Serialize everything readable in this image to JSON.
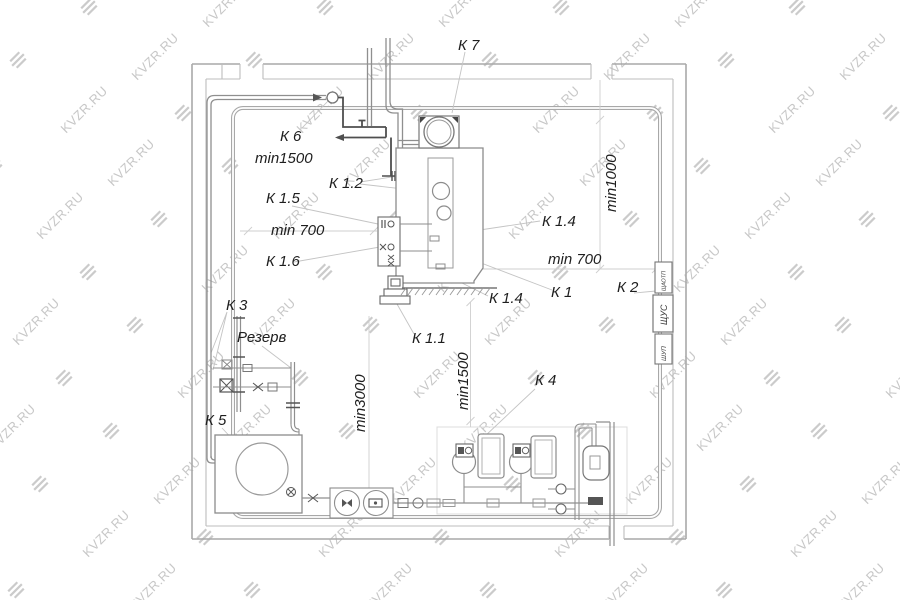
{
  "title": "Boiler room layout plan (план котельной)",
  "watermark": {
    "text": "KVZR.RU"
  },
  "labels": {
    "k7": "К 7",
    "k6": "К 6",
    "min1500_top": "min1500",
    "k12": "К 1.2",
    "k15": "К 1.5",
    "min700_left": "min 700",
    "k16": "К 1.6",
    "min1000": "min1000",
    "k14_top": "К 1.4",
    "min700_right": "min 700",
    "k1": "К 1",
    "k2": "К 2",
    "k14_bottom": "К 1.4",
    "k3": "К 3",
    "rezerv": "Резерв",
    "k11": "К 1.1",
    "min1500_mid": "min1500",
    "k4": "К 4",
    "min3000": "min3000",
    "k5": "К 5",
    "cabinet_top": "ЩАОТП",
    "cabinet_mid": "ЩУС",
    "cabinet_bottom": "ШУП"
  },
  "colors": {
    "wall": "#a9a9a9",
    "wall_inner": "#bdbdbd",
    "pipe_loop": "#a8a8a8",
    "pipe_gray": "#8f8f8f",
    "pipe_dark": "#4f4f4f",
    "equipment": "#8c8c8c",
    "equipment_dark": "#555555",
    "leader": "#c4c4c4",
    "dimension": "#cfcfcf",
    "label_text": "#1e1e1e",
    "watermark": "#c7c7c7",
    "background": "#ffffff"
  }
}
